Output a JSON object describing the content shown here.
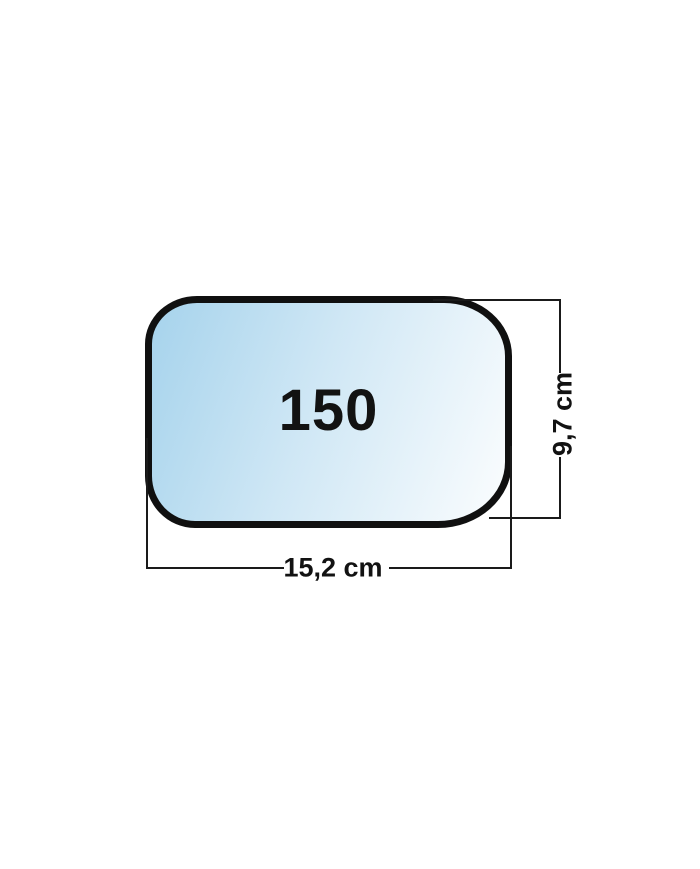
{
  "diagram": {
    "part_label": "150",
    "width_label": "15,2 cm",
    "height_label": "9,7 cm"
  },
  "colors": {
    "background": "#ffffff",
    "outline": "#101010",
    "line": "#1a1a1a",
    "glass_blue": "#a6d3ec",
    "glass_white": "#fbfdfe"
  }
}
